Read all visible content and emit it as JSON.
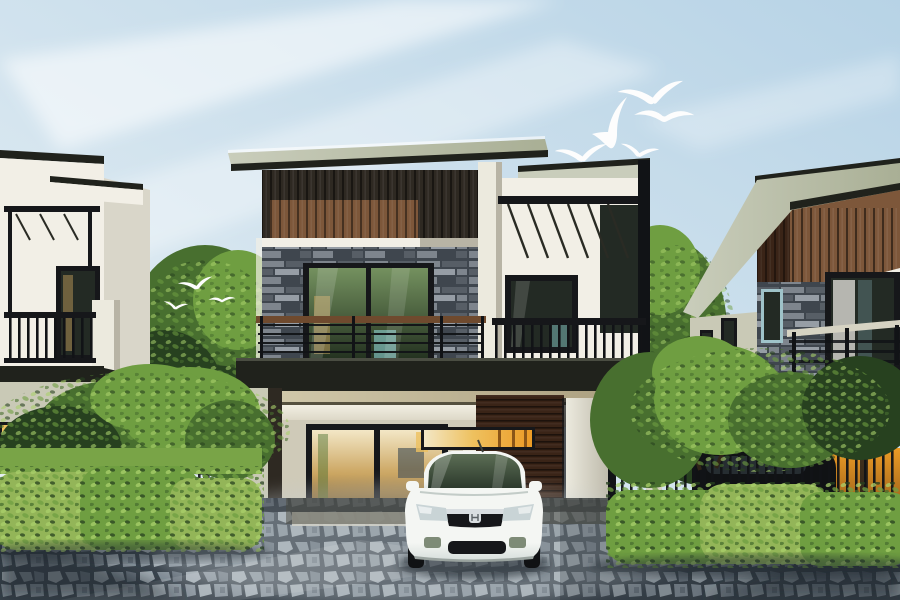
{
  "meta": {
    "width": 900,
    "height": 600,
    "kind": "architectural-render-photo"
  },
  "scene": {
    "description": "modern two-story house with carport, white sedan parked in cobblestone driveway, flanked by two similar houses, hedges and plumeria trees, seagulls in pale sky",
    "sky": {
      "cloud_streaks": 3,
      "flying_birds": 5,
      "perched_birds": 3
    },
    "houses": {
      "left": "white-two-story-house-with-balcony-pergola",
      "center": "modern-house-wood-slat-and-stone-facade",
      "right": "two-story-house-wood-band-stone-corner"
    },
    "vehicle": "white-sedan-front-view",
    "background_vehicle": "dark-car-behind-fence",
    "ground": "cobblestone-driveway",
    "vegetation": [
      "left-hedge",
      "right-hedge",
      "plumeria-trees",
      "background-trees",
      "grass-strip"
    ],
    "fences": [
      "left-black-fence",
      "right-black-fence-and-gate"
    ]
  },
  "palette": {
    "sky_deep": "#b7d3e6",
    "sky_pale": "#e9f1f5",
    "cloud_white": "#ffffff",
    "roof_light": "#a9af95",
    "roof_face": "#c9cdbb",
    "roof_dark": "#20221c",
    "band_dark": "#2e2922",
    "wood_brown": "#7d573a",
    "wood_choco": "#3a2417",
    "stone_base": "#575e66",
    "stone_dark": "#3f464e",
    "stone_light": "#7e858d",
    "stone_lighter": "#969da5",
    "wall_white": "#f2efe6",
    "wall_shadow": "#d9d6c9",
    "wall_olive": "#c9c9b6",
    "wall_beige": "#cfcab8",
    "frame_black": "#16171a",
    "metal_black": "#111316",
    "glass_green_top": "#74915f",
    "glass_green_low": "#22301f",
    "glass_dark": "#232a24",
    "teal": "#8fd4d4",
    "curtain": "#cba560",
    "amber_pale": "#f3e7c6",
    "amber": "#eec15f",
    "amber_bright": "#ec9b26",
    "amber_deep": "#8a5517",
    "rail_wood": "#6f4a2e",
    "fascia_beige": "#d4ccae",
    "fascia_beige2": "#a89c7c",
    "concrete": "#d6d3c3",
    "pillar_white": "#eceade",
    "pillar_shade": "#b8b4a5",
    "tree_dark": "#27411f",
    "tree_mid": "#486f2f",
    "tree_light": "#6f9e41",
    "leaf_hi": "#a9d06b",
    "grass": "#79a447",
    "hedge_hi": "#93b558",
    "pave_joint": "#39434c",
    "pave_a": "#a3adb4",
    "pave_b": "#87929b",
    "pave_c": "#6b7680",
    "pave_light": "#c6cdd2",
    "shadow_dark": "#232b32",
    "car_white": "#f4f6f3",
    "car_under": "#d6dedb",
    "car_glass_top": "#5c6e55",
    "car_glass_low": "#2c392c",
    "chrome": "#d9dee1",
    "car_dark": "#101214",
    "bird_white": "#fdfdfd"
  }
}
